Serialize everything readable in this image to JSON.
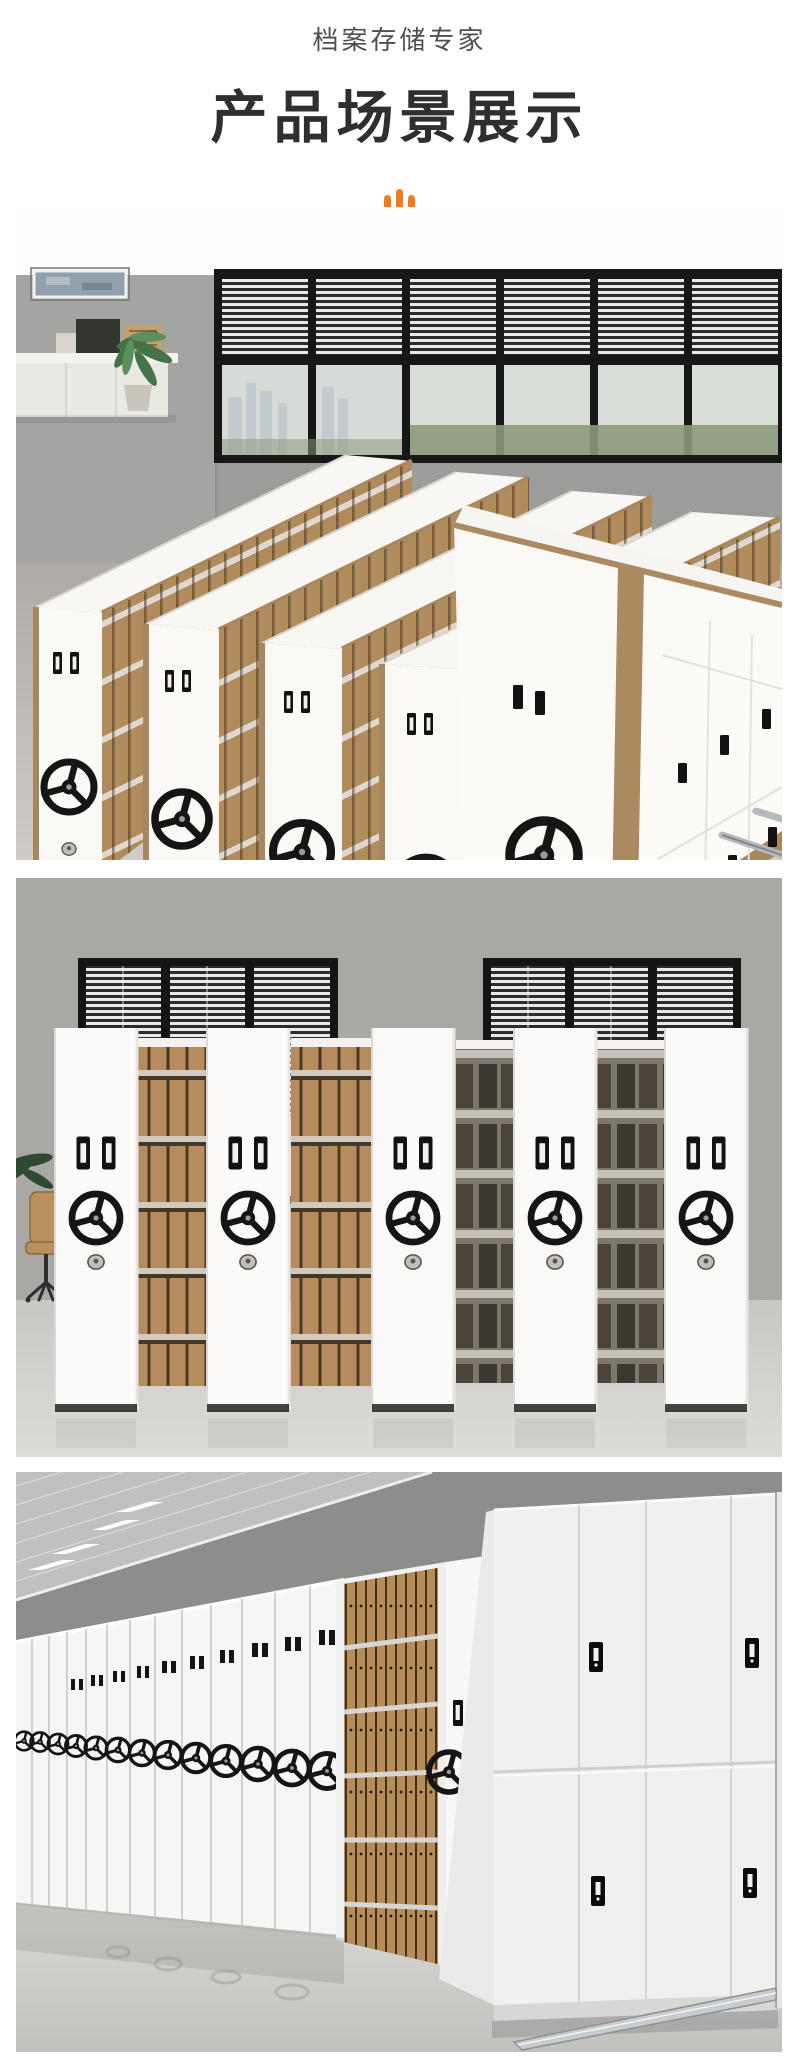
{
  "theme": {
    "accent": "#ee7c1f",
    "title-color": "#2f2f2f",
    "eyebrow-color": "#4f4f4f",
    "page-bg": "#ffffff"
  },
  "header": {
    "eyebrow": "档案存储专家",
    "title": "产品场景展示",
    "icon": "audio-bars-icon"
  },
  "gallery": {
    "scenes": [
      {
        "name": "office-mobile-shelving-perspective-scene"
      },
      {
        "name": "mobile-shelving-front-row-scene"
      },
      {
        "name": "archive-room-compact-shelving-scene"
      }
    ]
  }
}
